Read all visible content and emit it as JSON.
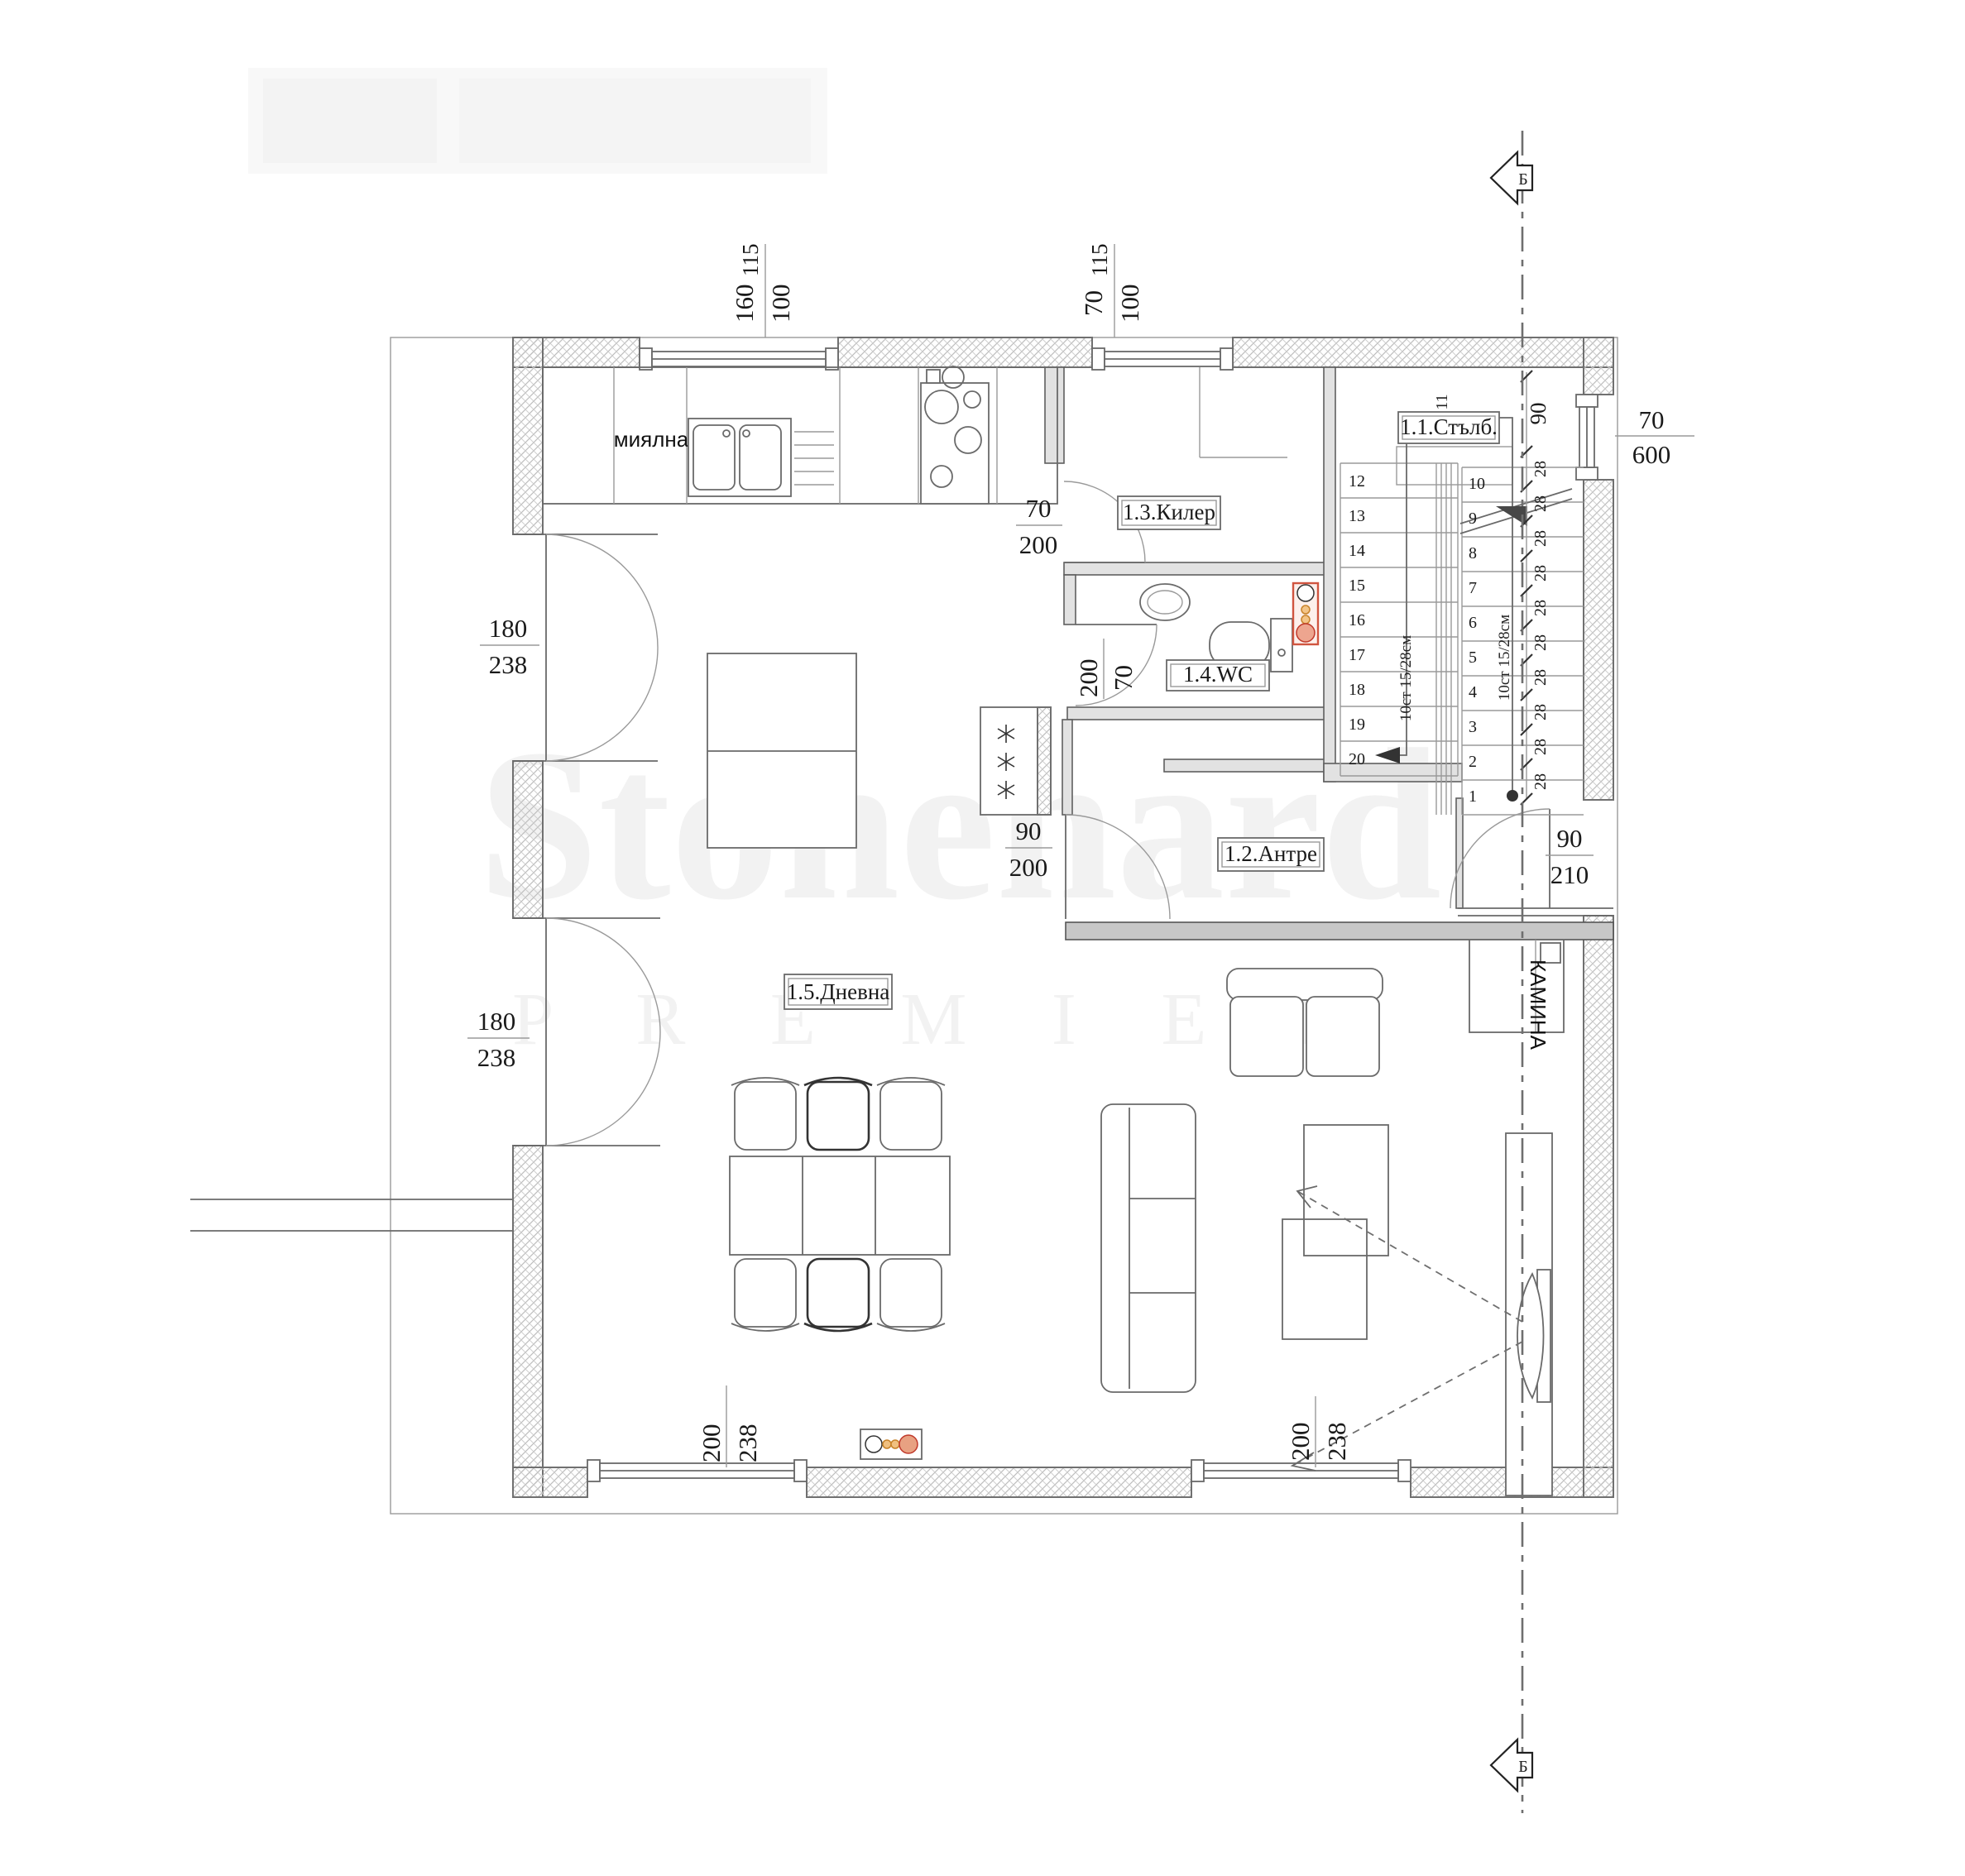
{
  "watermark": {
    "brand": "Stonehard",
    "premier": "P R E M I E R"
  },
  "room_labels": {
    "stairs": "1.1.Стълб.",
    "hall": "1.2.Антре",
    "closet": "1.3.Килер",
    "wc": "1.4.WC",
    "living": "1.5.Дневна"
  },
  "annotations": {
    "sink_area": "миялна",
    "fireplace": "КАМИНА"
  },
  "section": {
    "label": "Б"
  },
  "stairs": {
    "steps": [
      "1",
      "2",
      "3",
      "4",
      "5",
      "6",
      "7",
      "8",
      "9",
      "10",
      "11",
      "12",
      "13",
      "14",
      "15",
      "16",
      "17",
      "18",
      "19",
      "20"
    ],
    "tread_label": "28",
    "width_label": "90",
    "flight_note": "10ст 15/28см"
  },
  "dimensions": {
    "window_top_left": {
      "num": "160",
      "den": "100",
      "sill": "115"
    },
    "window_top_right": {
      "num": "70",
      "den": "100",
      "sill": "115"
    },
    "window_stair": {
      "num": "70",
      "den": "600"
    },
    "window_bottom_left": {
      "num": "200",
      "den": "238"
    },
    "window_bottom_right": {
      "num": "200",
      "den": "238"
    },
    "door_terrace_upper": {
      "num": "180",
      "den": "238"
    },
    "door_terrace_lower": {
      "num": "180",
      "den": "238"
    },
    "door_closet": {
      "num": "70",
      "den": "200"
    },
    "door_wc": {
      "num": "200",
      "den": "70"
    },
    "door_hall": {
      "num": "90",
      "den": "200"
    },
    "door_entrance": {
      "num": "90",
      "den": "210"
    }
  }
}
